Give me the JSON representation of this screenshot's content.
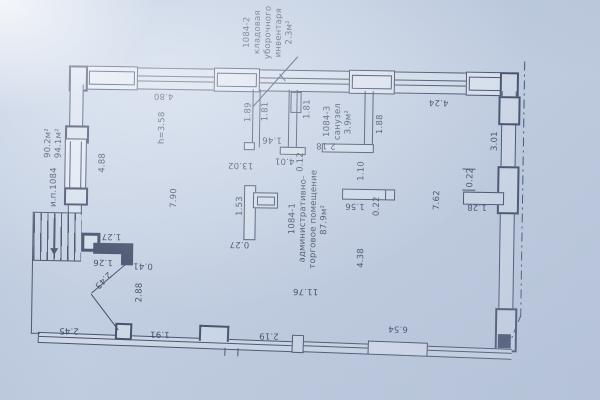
{
  "drawing": {
    "type": "apartment floor plan",
    "unit_number": "1084"
  },
  "colors": {
    "paper": "#cbd6e7",
    "line": "#27314e",
    "text": "#1d2742",
    "wall_fill": "#dde5f0",
    "window_fill": "#e9eef7"
  },
  "room_labels": [
    {
      "name": "room-label-storage",
      "lines": [
        "1084-2",
        "кладовая",
        "уборочного",
        "инвентаря",
        "2.3м²"
      ],
      "x": 266,
      "y": 33
    },
    {
      "name": "room-label-sanuzel",
      "lines": [
        "1084-3",
        "санузел",
        "3.9м²"
      ],
      "x": 337,
      "y": 121
    },
    {
      "name": "room-label-main",
      "lines": [
        "1084-1",
        "административно-",
        "торговое помещение",
        "87.9м²"
      ],
      "x": 309,
      "y": 219
    },
    {
      "name": "area-label",
      "lines": [
        "90.2м²",
        "94.1м²"
      ],
      "x": 53,
      "y": 147
    },
    {
      "name": "unit-label",
      "lines": [
        "и.п.1084"
      ],
      "x": 54,
      "y": 191
    }
  ],
  "dimension_labels": [
    {
      "text": "4.80",
      "x": 162,
      "y": 98,
      "rot": 180
    },
    {
      "text": "4.24",
      "x": 437,
      "y": 100,
      "rot": 180
    },
    {
      "text": "1.89",
      "x": 247,
      "y": 113,
      "rot": -90
    },
    {
      "text": "1.81",
      "x": 264,
      "y": 112,
      "rot": -90
    },
    {
      "text": "1.81",
      "x": 306,
      "y": 109,
      "rot": -90
    },
    {
      "text": "1.88",
      "x": 379,
      "y": 123,
      "rot": -90
    },
    {
      "text": "3.01",
      "x": 494,
      "y": 138,
      "rot": -90
    },
    {
      "text": "h=3.58",
      "x": 161,
      "y": 130,
      "rot": -90
    },
    {
      "text": "4.88",
      "x": 102,
      "y": 166,
      "rot": -90
    },
    {
      "text": "1.46",
      "x": 271,
      "y": 140,
      "rot": 180
    },
    {
      "text": "2.18",
      "x": 325,
      "y": 145,
      "rot": 180
    },
    {
      "text": "13.02",
      "x": 240,
      "y": 166,
      "rot": 180
    },
    {
      "text": "4.01",
      "x": 284,
      "y": 161,
      "rot": 180
    },
    {
      "text": "0.12",
      "x": 300,
      "y": 162,
      "rot": -90
    },
    {
      "text": "1.10",
      "x": 361,
      "y": 170,
      "rot": -90
    },
    {
      "text": "0.22",
      "x": 470,
      "y": 175,
      "rot": -90
    },
    {
      "text": "7.62",
      "x": 437,
      "y": 198,
      "rot": -90
    },
    {
      "text": "1.28",
      "x": 477,
      "y": 204,
      "rot": 180
    },
    {
      "text": "7.90",
      "x": 174,
      "y": 200,
      "rot": -90
    },
    {
      "text": "1.53",
      "x": 240,
      "y": 207,
      "rot": -90
    },
    {
      "text": "0.27",
      "x": 240,
      "y": 245,
      "rot": 180
    },
    {
      "text": "1.56",
      "x": 355,
      "y": 205,
      "rot": 180
    },
    {
      "text": "0.22",
      "x": 377,
      "y": 205,
      "rot": -90
    },
    {
      "text": "4.38",
      "x": 362,
      "y": 257,
      "rot": -90
    },
    {
      "text": "1.27",
      "x": 112,
      "y": 239,
      "rot": 180
    },
    {
      "text": "1.26",
      "x": 104,
      "y": 265,
      "rot": 180
    },
    {
      "text": "0.41",
      "x": 144,
      "y": 268,
      "rot": 180
    },
    {
      "text": "2.43",
      "x": 104,
      "y": 283,
      "rot": 133
    },
    {
      "text": "2.88",
      "x": 141,
      "y": 295,
      "rot": -90
    },
    {
      "text": "11.76",
      "x": 307,
      "y": 291,
      "rot": 180
    },
    {
      "text": "2.45",
      "x": 71,
      "y": 334,
      "rot": 180
    },
    {
      "text": "1.91",
      "x": 162,
      "y": 336,
      "rot": 180
    },
    {
      "text": "2.19",
      "x": 271,
      "y": 336,
      "rot": 180
    },
    {
      "text": "6.54",
      "x": 400,
      "y": 327,
      "rot": 180
    },
    {
      "text": "4.38",
      "x": 0,
      "y": 0,
      "rot": 0
    }
  ]
}
